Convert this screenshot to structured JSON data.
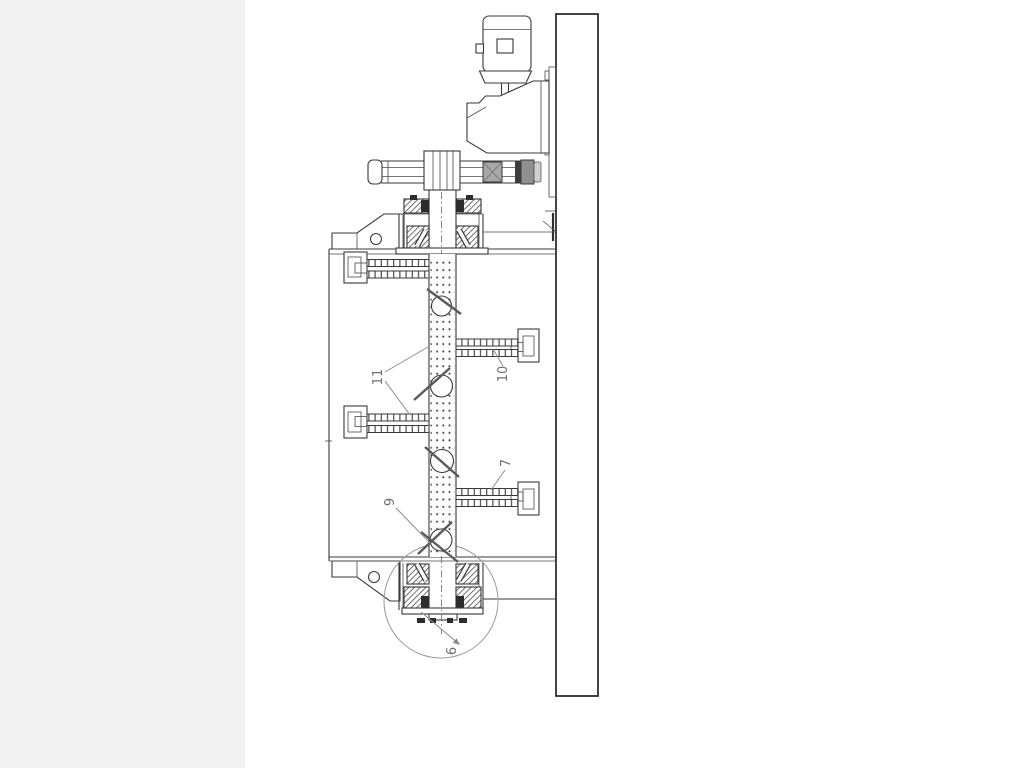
{
  "page": {
    "background": "#ffffff",
    "margin_color": "#f2f2f2"
  },
  "drawing": {
    "type": "technical-line-drawing",
    "part_labels": [
      {
        "ref": "11"
      },
      {
        "ref": "10"
      },
      {
        "ref": "7"
      },
      {
        "ref": "9"
      },
      {
        "ref": "6"
      }
    ],
    "colors": {
      "line": "#3a3a3a",
      "leader": "#8c8c8c",
      "hatch": "#3f3f3f",
      "fill_gray_light": "#a8a8a8",
      "fill_gray_mid": "#8f8f8f",
      "fill_gray_dark": "#3d3d3d",
      "fill_end_cap": "#cfcfcf",
      "background": "#ffffff"
    }
  }
}
